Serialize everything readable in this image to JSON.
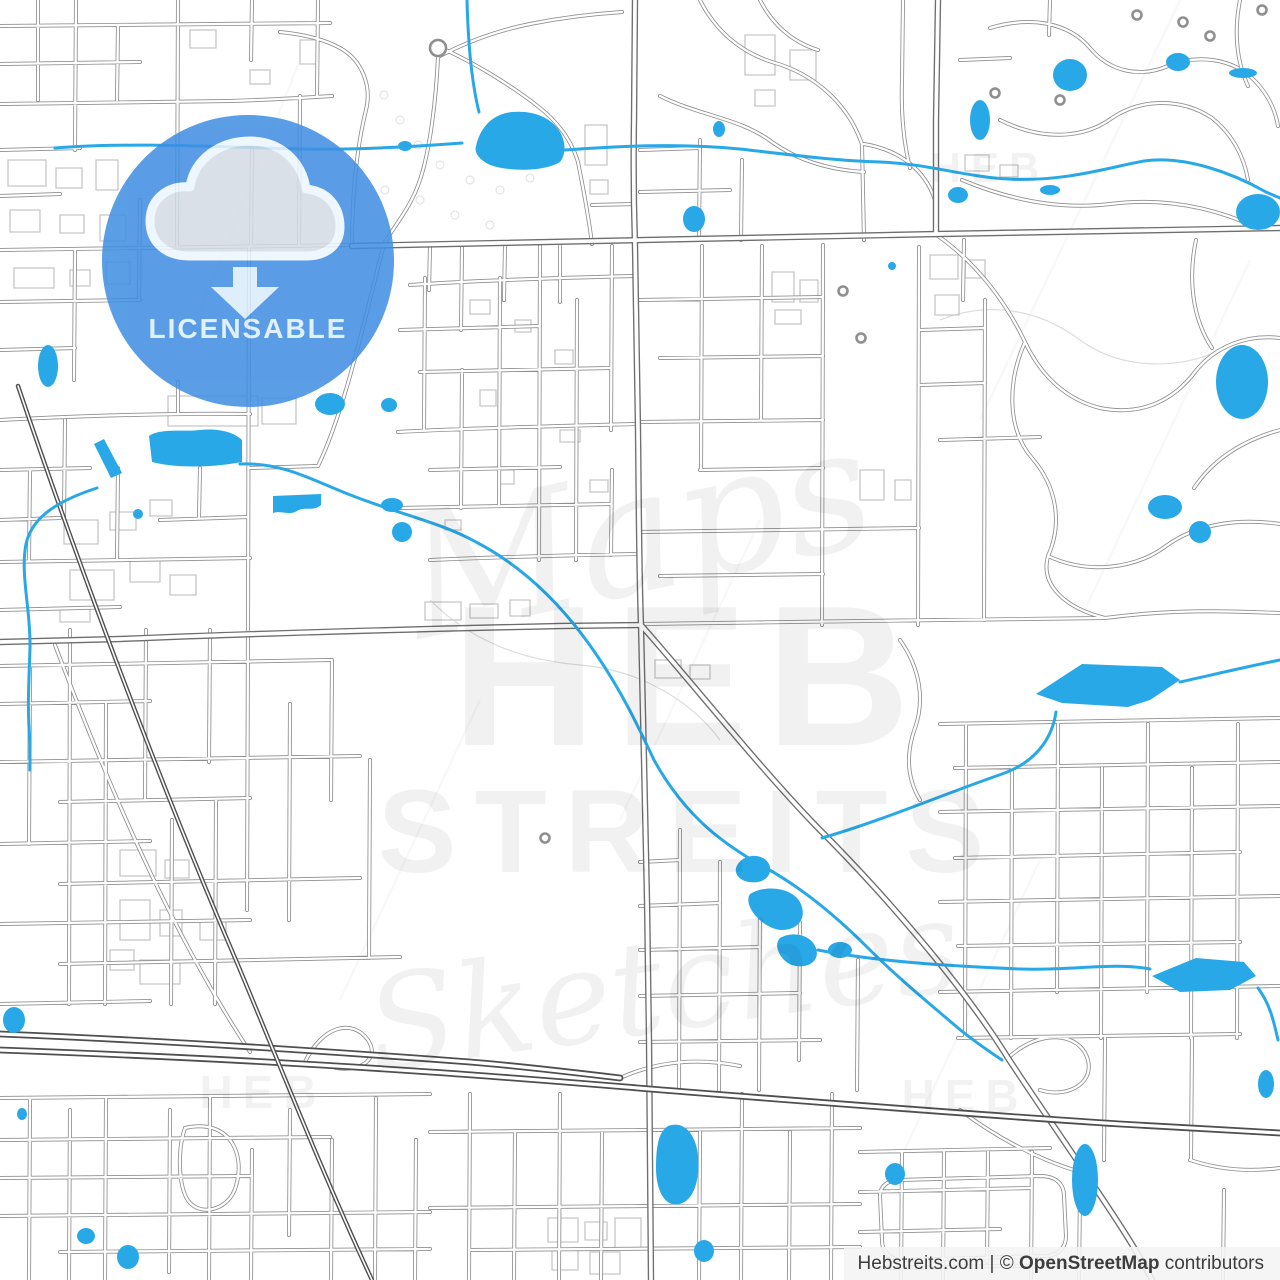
{
  "map": {
    "watermark": {
      "script_top": "Maps",
      "title_line1": "HEB",
      "title_line2": "STREITS",
      "script_bottom": "Sketches",
      "tile": "HEB"
    },
    "colors": {
      "background": "#ffffff",
      "water": "#29a8e8",
      "road_minor": "#8f8f8f",
      "road_major": "#6e6e6e",
      "road_dark": "#4f4f4f",
      "building": "#c6c6c6",
      "badge_blue": "#3f8ee2"
    }
  },
  "badge": {
    "label": "LICENSABLE",
    "icon": "cloud-download-icon"
  },
  "attribution": {
    "site": "Hebstreits.com",
    "divider": "|",
    "copyright": "©",
    "source": "OpenStreetMap",
    "suffix": "contributors"
  }
}
